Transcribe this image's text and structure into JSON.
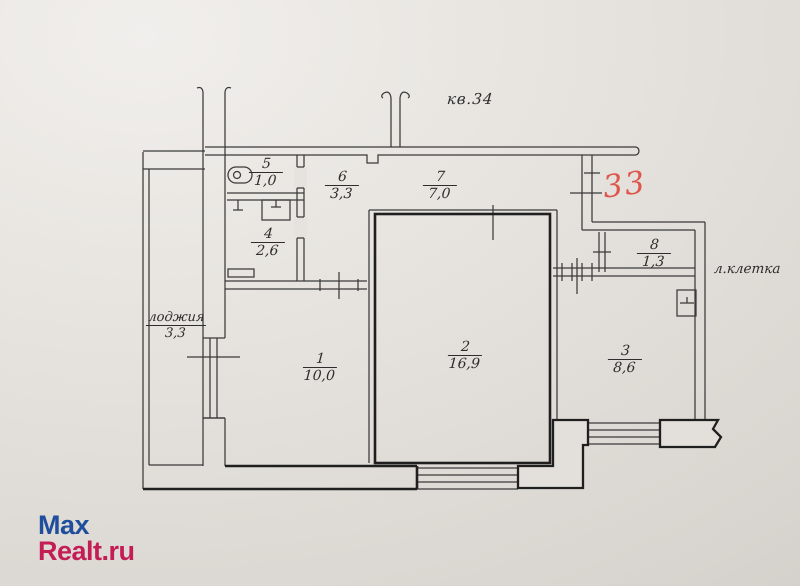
{
  "page": {
    "background_color": "#e3e0db",
    "line_color": "#3a3a3a",
    "heavy_line_color": "#1f1f1f"
  },
  "watermark": {
    "line1": "Max",
    "line2": "Realt.ru",
    "color1": "#1e4e9c",
    "color2": "#c41d56"
  },
  "plan": {
    "apartment_label": "кв.34",
    "stairwell_label": "л.клетка",
    "handwritten_number": "33",
    "handwritten_color": "#de574d",
    "loggia": {
      "name": "лоджия",
      "area": "3,3"
    },
    "rooms": [
      {
        "number": "1",
        "area": "10,0"
      },
      {
        "number": "2",
        "area": "16,9"
      },
      {
        "number": "3",
        "area": "8,6"
      },
      {
        "number": "4",
        "area": "2,6"
      },
      {
        "number": "5",
        "area": "1,0"
      },
      {
        "number": "6",
        "area": "3,3"
      },
      {
        "number": "7",
        "area": "7,0"
      },
      {
        "number": "8",
        "area": "1,3"
      }
    ],
    "icons": [
      "vent-pipe-icon",
      "sink-icon",
      "toilet-icon",
      "cistern-icon",
      "window-symbol",
      "door-tick-symbol",
      "wall-break-symbol",
      "electrical-panel-icon"
    ]
  }
}
